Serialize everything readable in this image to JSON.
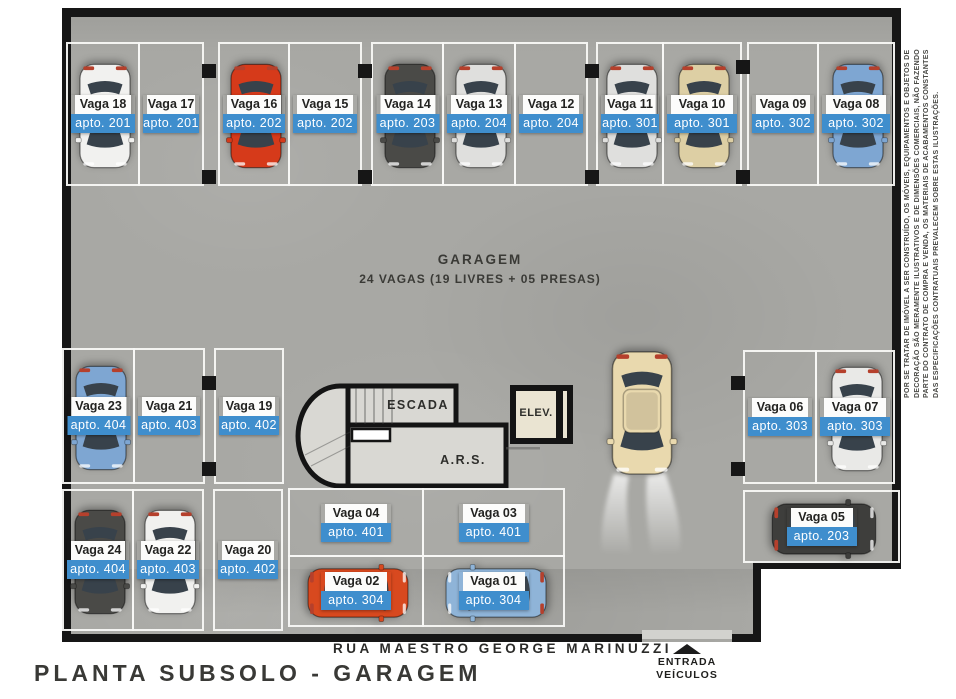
{
  "title": "PLANTA SUBSOLO - GARAGEM",
  "street": "RUA MAESTRO GEORGE MARINUZZI",
  "entrance": {
    "line1": "ENTRADA",
    "line2": "VEÍCULOS"
  },
  "center": {
    "title": "GARAGEM",
    "subtitle": "24 VAGAS (19 LIVRES + 05 PRESAS)"
  },
  "rooms": {
    "stairs": "ESCADA",
    "ars": "A.R.S.",
    "elevator": "ELEV."
  },
  "disclaimer": [
    "POR SE TRATAR DE IMÓVEL A SER CONSTRUÍDO, OS MÓVEIS, EQUIPAMENTOS E OBJETOS DE",
    "DECORAÇÃO SÃO MERAMENTE ILUSTRATIVOS E DE DIMENSÕES COMERCIAIS, NÃO FAZENDO",
    "PARTE DO CONTRATO DE COMPRA E VENDA, OS MATERIAIS DE ACABAMENTOS CONSTANTES",
    "DAS ESPECIFICAÇÕES CONTRATUAIS PREVALECEM SOBRE ESTAS ILUSTRAÇÕES."
  ],
  "colors": {
    "floor": "#a8a8a4",
    "label_blue": "#3f8ecd",
    "line_black": "#161616",
    "stall_line": "#f4f4f2",
    "stair_fill": "#d9d8d3",
    "elevator_fill": "#eae4d2",
    "car_white": "#f1f1ef",
    "car_white2": "#e9e9e7",
    "car_silver": "#dfdfdd",
    "car_red": "#d63a1a",
    "car_red2": "#d8491f",
    "car_dark": "#4a4a47",
    "car_dark2": "#3e3e3c",
    "car_beige": "#ddcfa4",
    "car_beige2": "#e9d9ae",
    "car_blue": "#7ea6d2",
    "car_blue2": "#8fb4d8"
  },
  "aisle_car": {
    "color": "car_beige2",
    "dir": "down",
    "cx": 642,
    "cy": 413,
    "cw": 76,
    "ch": 130
  },
  "columns": [
    [
      202,
      64
    ],
    [
      202,
      170
    ],
    [
      358,
      64
    ],
    [
      358,
      170
    ],
    [
      585,
      64
    ],
    [
      585,
      170
    ],
    [
      736,
      60
    ],
    [
      736,
      170
    ],
    [
      202,
      376
    ],
    [
      202,
      462
    ],
    [
      731,
      376
    ],
    [
      731,
      462
    ]
  ],
  "spots": [
    {
      "name": "Vaga 18",
      "apto": "apto. 201",
      "car": "car_white",
      "dir": "down",
      "x": 66,
      "y": 42,
      "w": 74,
      "h": 144
    },
    {
      "name": "Vaga 17",
      "apto": "apto. 201",
      "car": null,
      "x": 138,
      "y": 42,
      "w": 66,
      "h": 144
    },
    {
      "name": "Vaga 16",
      "apto": "apto. 202",
      "car": "car_red",
      "dir": "down",
      "x": 218,
      "y": 42,
      "w": 72,
      "h": 144
    },
    {
      "name": "Vaga 15",
      "apto": "apto. 202",
      "car": null,
      "x": 288,
      "y": 42,
      "w": 74,
      "h": 144
    },
    {
      "name": "Vaga 14",
      "apto": "apto. 203",
      "car": "car_dark",
      "dir": "down",
      "x": 371,
      "y": 42,
      "w": 73,
      "h": 144
    },
    {
      "name": "Vaga 13",
      "apto": "apto. 204",
      "car": "car_silver",
      "dir": "down",
      "x": 442,
      "y": 42,
      "w": 74,
      "h": 144
    },
    {
      "name": "Vaga 12",
      "apto": "apto. 204",
      "car": null,
      "x": 514,
      "y": 42,
      "w": 74,
      "h": 144
    },
    {
      "name": "Vaga 11",
      "apto": "apto. 301",
      "car": "car_silver",
      "dir": "down",
      "x": 596,
      "y": 42,
      "w": 68,
      "h": 144
    },
    {
      "name": "Vaga 10",
      "apto": "apto. 301",
      "car": "car_beige",
      "dir": "down",
      "x": 662,
      "y": 42,
      "w": 80,
      "h": 144
    },
    {
      "name": "Vaga 09",
      "apto": "apto. 302",
      "car": null,
      "x": 747,
      "y": 42,
      "w": 72,
      "h": 144
    },
    {
      "name": "Vaga 08",
      "apto": "apto. 302",
      "car": "car_blue",
      "dir": "down",
      "x": 817,
      "y": 42,
      "w": 78,
      "h": 144
    },
    {
      "name": "Vaga 23",
      "apto": "apto. 404",
      "car": "car_blue",
      "dir": "down",
      "x": 62,
      "y": 348,
      "w": 73,
      "h": 136
    },
    {
      "name": "Vaga 21",
      "apto": "apto. 403",
      "car": null,
      "x": 133,
      "y": 348,
      "w": 72,
      "h": 136
    },
    {
      "name": "Vaga 19",
      "apto": "apto. 402",
      "car": null,
      "x": 214,
      "y": 348,
      "w": 70,
      "h": 136
    },
    {
      "name": "Vaga 06",
      "apto": "apto. 303",
      "car": null,
      "x": 743,
      "y": 350,
      "w": 74,
      "h": 134
    },
    {
      "name": "Vaga 07",
      "apto": "apto. 303",
      "car": "car_white2",
      "dir": "down",
      "x": 815,
      "y": 350,
      "w": 80,
      "h": 134
    },
    {
      "name": "Vaga 24",
      "apto": "apto. 404",
      "car": "car_dark",
      "dir": "down",
      "x": 62,
      "y": 489,
      "w": 72,
      "h": 142
    },
    {
      "name": "Vaga 22",
      "apto": "apto. 403",
      "car": "car_white",
      "dir": "down",
      "x": 132,
      "y": 489,
      "w": 72,
      "h": 142
    },
    {
      "name": "Vaga 20",
      "apto": "apto. 402",
      "car": null,
      "x": 213,
      "y": 489,
      "w": 70,
      "h": 142
    },
    {
      "name": "Vaga 04",
      "apto": "apto. 401",
      "car": null,
      "x": 288,
      "y": 488,
      "w": 136,
      "h": 69
    },
    {
      "name": "Vaga 03",
      "apto": "apto. 401",
      "car": null,
      "x": 422,
      "y": 488,
      "w": 143,
      "h": 69
    },
    {
      "name": "Vaga 02",
      "apto": "apto. 304",
      "car": "car_red2",
      "dir": "right",
      "x": 288,
      "y": 555,
      "w": 136,
      "h": 72,
      "cs": [
        58,
        118
      ]
    },
    {
      "name": "Vaga 01",
      "apto": "apto. 304",
      "car": "car_blue2",
      "dir": "left",
      "x": 422,
      "y": 555,
      "w": 143,
      "h": 72,
      "cs": [
        58,
        128
      ]
    },
    {
      "name": "Vaga 05",
      "apto": "apto. 203",
      "car": "car_dark2",
      "dir": "right",
      "x": 743,
      "y": 490,
      "w": 157,
      "h": 73,
      "cs": [
        60,
        140
      ]
    }
  ]
}
